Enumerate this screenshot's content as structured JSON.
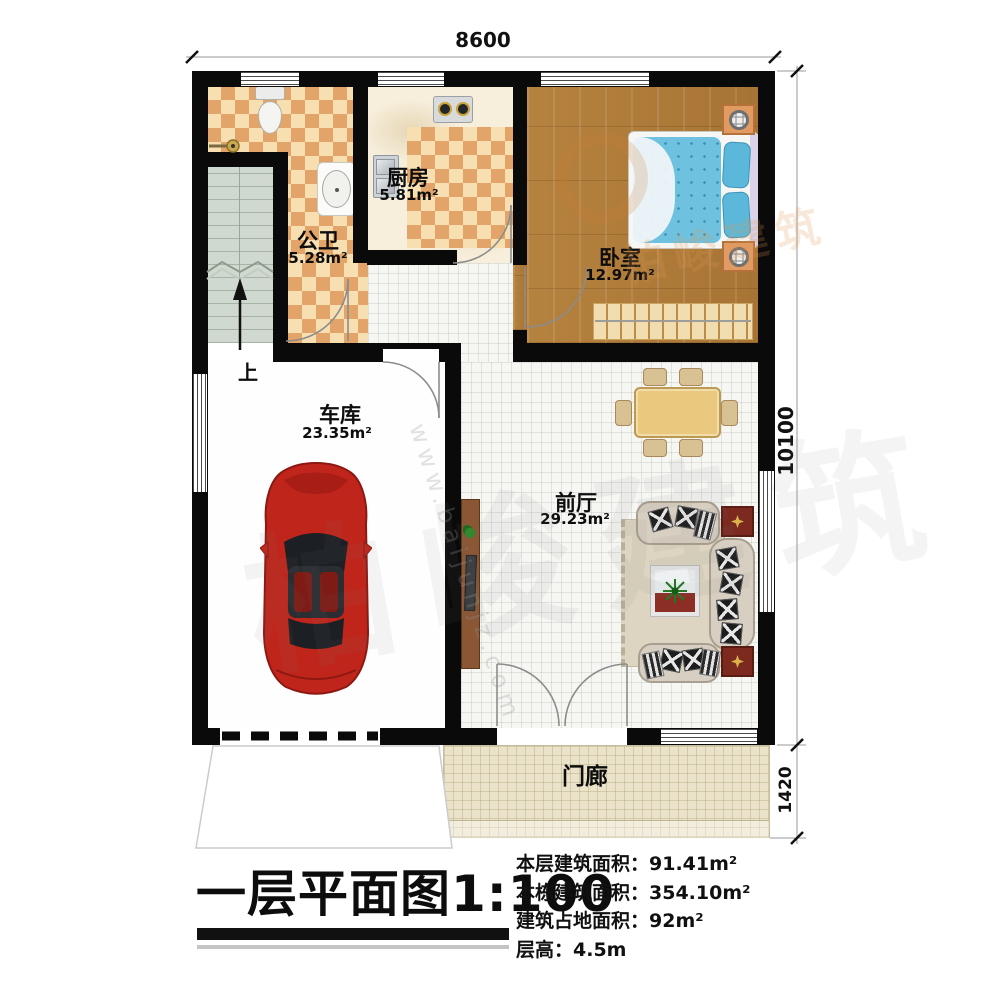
{
  "dimensions": {
    "top_width": "8600",
    "right_height": "10100",
    "porch_height": "1420"
  },
  "rooms": {
    "bathroom": {
      "name": "公卫",
      "area": "5.28m²"
    },
    "kitchen": {
      "name": "厨房",
      "area": "5.81m²"
    },
    "bedroom": {
      "name": "卧室",
      "area": "12.97m²"
    },
    "garage": {
      "name": "车库",
      "area": "23.35m²"
    },
    "hall": {
      "name": "前厅",
      "area": "29.23m²"
    },
    "porch": {
      "name": "门廊"
    },
    "stairs": {
      "direction_label": "上"
    }
  },
  "title_block": {
    "title": "一层平面图1:100",
    "lines": [
      "本层建筑面积：91.41m²",
      "本栋建筑面积：354.10m²",
      "建筑占地面积：92m²",
      "层高：4.5m"
    ]
  },
  "watermark": {
    "logo_text": "柏峻建筑",
    "url_text": "www.baijunjz.com"
  },
  "colors": {
    "wall": "#0a0a0a",
    "tile_dark": "#e2a468",
    "tile_light": "#f7dfb2",
    "wood": "#b17d3b",
    "hall_tile": "#f6f6f3",
    "porch": "#eae3c9",
    "stairs": "#d0d9cf",
    "mattress": "#6ec2e0",
    "car_body": "#c0251c",
    "side_table": "#7c2a20"
  }
}
